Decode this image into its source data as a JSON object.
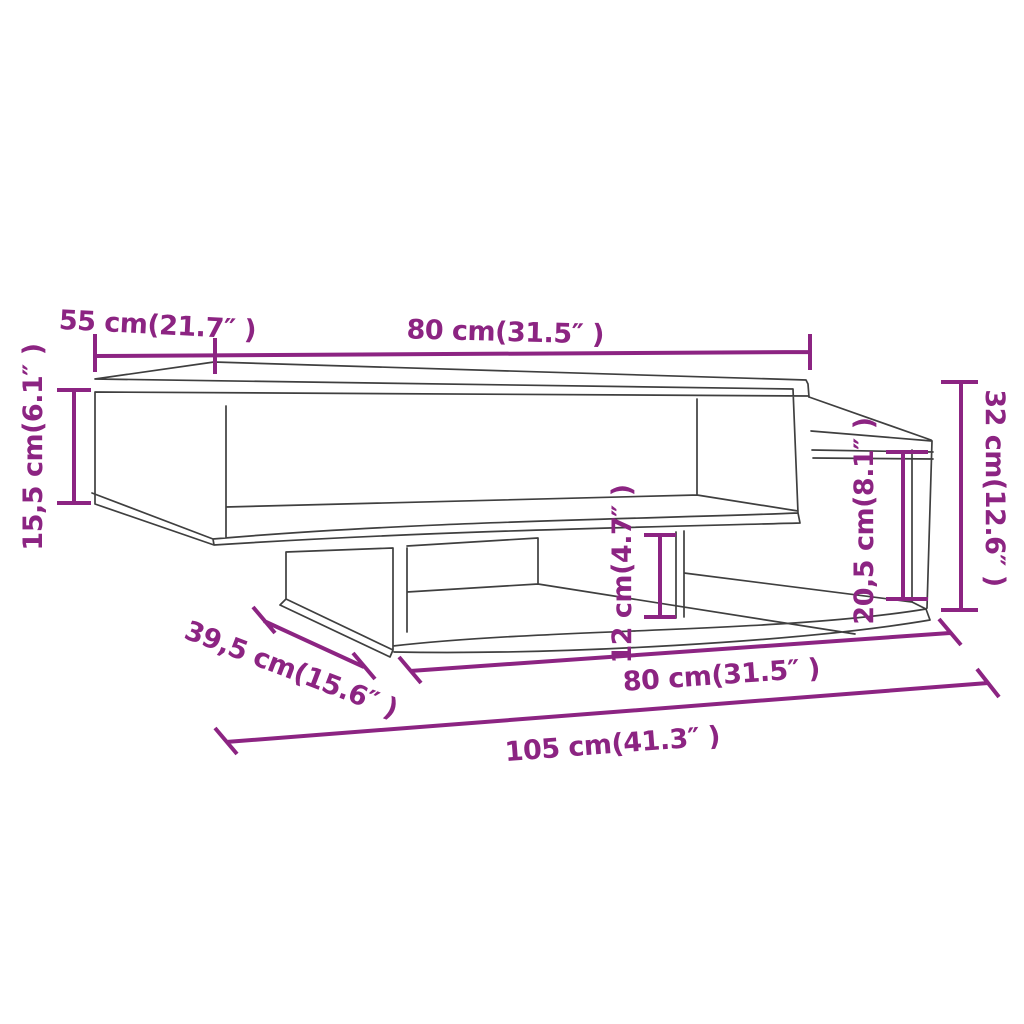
{
  "colors": {
    "accent": "#8C2482",
    "outline": "#3F3F3F",
    "background": "#FFFFFF"
  },
  "diagram": {
    "kind": "furniture-dimension-line-drawing",
    "subject": "two-tier coffee table with open compartments and side shelf step",
    "dimensions": {
      "top_depth": {
        "cm": "55",
        "inch": "21.7",
        "label": "55 cm(21.7″ )"
      },
      "top_width": {
        "cm": "80",
        "inch": "31.5",
        "label": "80 cm(31.5″ )"
      },
      "top_unit_height": {
        "cm": "15,5",
        "inch": "6.1",
        "label": "15,5 cm(6.1″ )"
      },
      "total_height": {
        "cm": "32",
        "inch": "12.6",
        "label": "32 cm(12.6″ )"
      },
      "side_shelf_height": {
        "cm": "20,5",
        "inch": "8.1",
        "label": "20,5 cm(8.1″ )"
      },
      "base_gap_height": {
        "cm": "12",
        "inch": "4.7",
        "label": "12 cm(4.7″ )"
      },
      "base_depth": {
        "cm": "39,5",
        "inch": "15.6",
        "label": "39,5 cm(15.6″ )"
      },
      "base_width": {
        "cm": "80",
        "inch": "31.5",
        "label": "80 cm(31.5″ )"
      },
      "total_width": {
        "cm": "105",
        "inch": "41.3",
        "label": "105 cm(41.3″ )"
      }
    }
  }
}
